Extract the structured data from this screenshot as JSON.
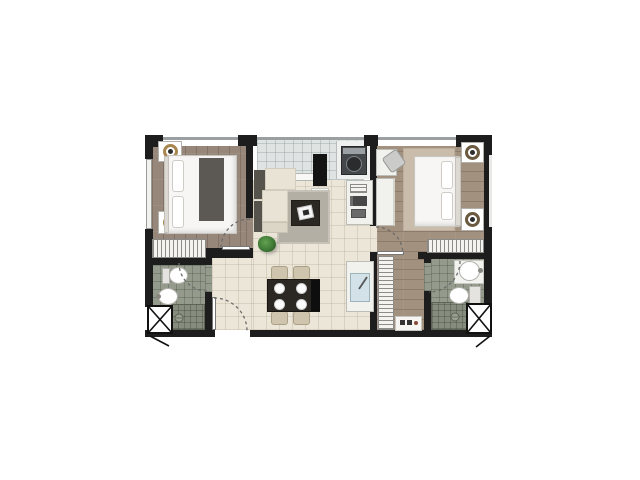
{
  "meta": {
    "type": "2d-architectural-floor-plan-rendering",
    "subject": "two-bedroom, two-bathroom apartment unit, top-down render on white background",
    "visible_text": []
  },
  "palette": {
    "background": "#ffffff",
    "wall": "#1d1d1d",
    "wood_bedroom_1": "#97877a",
    "wood_bedroom_2": "#a39180",
    "tile_living": "#ece6d9",
    "tile_balcony": "#dfe3e2",
    "tile_bathroom": "#949b8c",
    "tile_shower": "#868d7e",
    "rug_living": "#b4afa5",
    "rug_bedroom": "#c9bcaa",
    "sofa_cream": "#e9e3d5",
    "sofa_dark": "#56524c",
    "table_dark": "#2b2823",
    "chair_beige": "#cfc4ae",
    "bed_white": "#f7f6f4",
    "bed_runner": "#5c5954",
    "lamp_gold": "#a8874f",
    "plant_green": "#3f7a36",
    "sink_water": "#d3e2e8",
    "appliance_dark": "#45484b",
    "door_arc": "#6b6b6b"
  },
  "rooms": [
    {
      "name": "Bedroom 1",
      "floor": "wood plank (vertical boards)",
      "furniture": [
        "double bed with dark grey runner",
        "two bedside tables with round gold lamps",
        "built-in wardrobe along south wall",
        "hinged door with swing arc"
      ]
    },
    {
      "name": "Bathroom 1",
      "floor": "green-grey tile",
      "fixtures": [
        "toilet",
        "round washbasin",
        "walk-in shower with floor drain",
        "hinged door with swing arc",
        "service shaft with X symbol"
      ]
    },
    {
      "name": "Living / Dining",
      "floor": "cream tile",
      "furniture": [
        "L-shaped sofa (cream with dark back)",
        "grey area rug",
        "dark square coffee table with white tray",
        "potted plant",
        "black TV partition wall with white shelf",
        "dark dining table with four white plates",
        "four beige dining chairs",
        "entrance door with swing arc"
      ]
    },
    {
      "name": "Balcony / Utility strip",
      "floor": "light grid tile",
      "furniture": [
        "washing machine on counter",
        "low white ledge / sliding frame"
      ]
    },
    {
      "name": "Kitchen strip",
      "floor": "cream tile",
      "furniture": [
        "tall appliance / shelf unit",
        "counter with sink and faucet"
      ]
    },
    {
      "name": "Bedroom 2",
      "floor": "wood plank (horizontal boards)",
      "furniture": [
        "double bed",
        "two bedside tables with round lamps",
        "desk with chair",
        "wall console",
        "wardrobe along south wall",
        "second wardrobe in dressing corridor",
        "beige rug",
        "floor mat with slippers",
        "hinged door with swing arc"
      ]
    },
    {
      "name": "Bathroom 2",
      "floor": "green-grey tile",
      "fixtures": [
        "round washbasin on counter",
        "toilet",
        "walk-in shower with floor drain",
        "hinged door with swing arc",
        "service shaft with X symbol"
      ]
    }
  ]
}
